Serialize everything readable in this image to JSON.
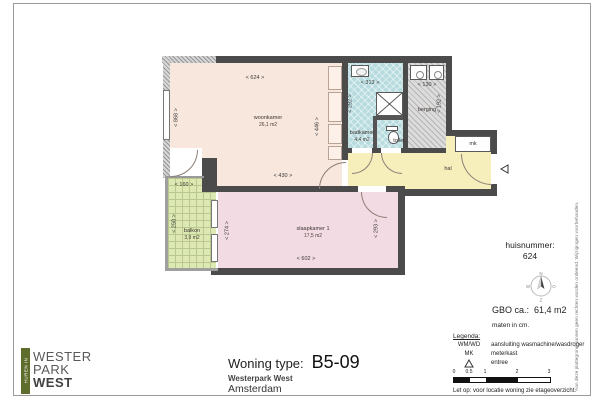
{
  "title_block": {
    "type_label": "Woning type:",
    "type_value": "B5-09",
    "project": "Westerpark West",
    "city": "Amsterdam"
  },
  "logo": {
    "vertical": "HUREN IN",
    "line1": "WESTER",
    "line2": "PARK",
    "line3": "WEST"
  },
  "info": {
    "huisnummer_label": "huisnummer:",
    "huisnummer_value": "624",
    "gbo": "GBO ca.:  61,4 m2",
    "units": "maten in cm.",
    "note_label": "Let op:",
    "note_text": "voor locatie woning zie etageoverzicht.",
    "disclaimer": "Aan deze plattegrond kunnen geen rechten worden ontleend. Wijzigingen voorbehouden."
  },
  "compass": {
    "n": "N",
    "e": "O",
    "s": "Z",
    "w": "W"
  },
  "legend": {
    "title": "Legenda:",
    "items": [
      {
        "key": "WM/WD",
        "value": "aansluiting wasmachine/wasdroger"
      },
      {
        "key": "MK",
        "value": "meterkast"
      },
      {
        "key": "",
        "value": "entree"
      }
    ],
    "scale_ticks": [
      "0",
      "0.5",
      "1",
      "2",
      "3"
    ]
  },
  "rooms": {
    "woonkamer": {
      "name": "woonkamer",
      "area": "26,1 m2"
    },
    "slaapkamer": {
      "name": "slaapkamer 1",
      "area": "17,5 m2"
    },
    "badkamer": {
      "name": "badkamer",
      "area": "4,4 m2"
    },
    "balkon": {
      "name": "balkon",
      "area": "3,9 m2"
    },
    "berging": {
      "name": "berging"
    },
    "toilet": {
      "name": "toilet"
    },
    "hal": {
      "name": "hal"
    },
    "mk": {
      "name": "mk"
    }
  },
  "dims": {
    "woon_top": "< 624 >",
    "woon_left": "< 868 >",
    "woon_right": "< 446 >",
    "woon_bottom": "< 430 >",
    "bad_w": "< 313 >",
    "bad_h": "< 292 >",
    "berg_w": "< 130 >",
    "berg_h": "< 192 >",
    "slaap_left": "< 274 >",
    "slaap_right": "< 293 >",
    "slaap_bottom": "< 602 >",
    "balk_w": "< 160 >",
    "balk_h": "< 250 >"
  },
  "colors": {
    "wall": "#4b4b4b",
    "woonkamer": "#f8e7dd",
    "slaapkamer": "#f3dbe4",
    "badkamer": "#b7dbde",
    "hal": "#f6efbc",
    "balkon": "#dde8b2",
    "berging": "#dcdcdc",
    "logo_green": "#5f6d2c"
  }
}
